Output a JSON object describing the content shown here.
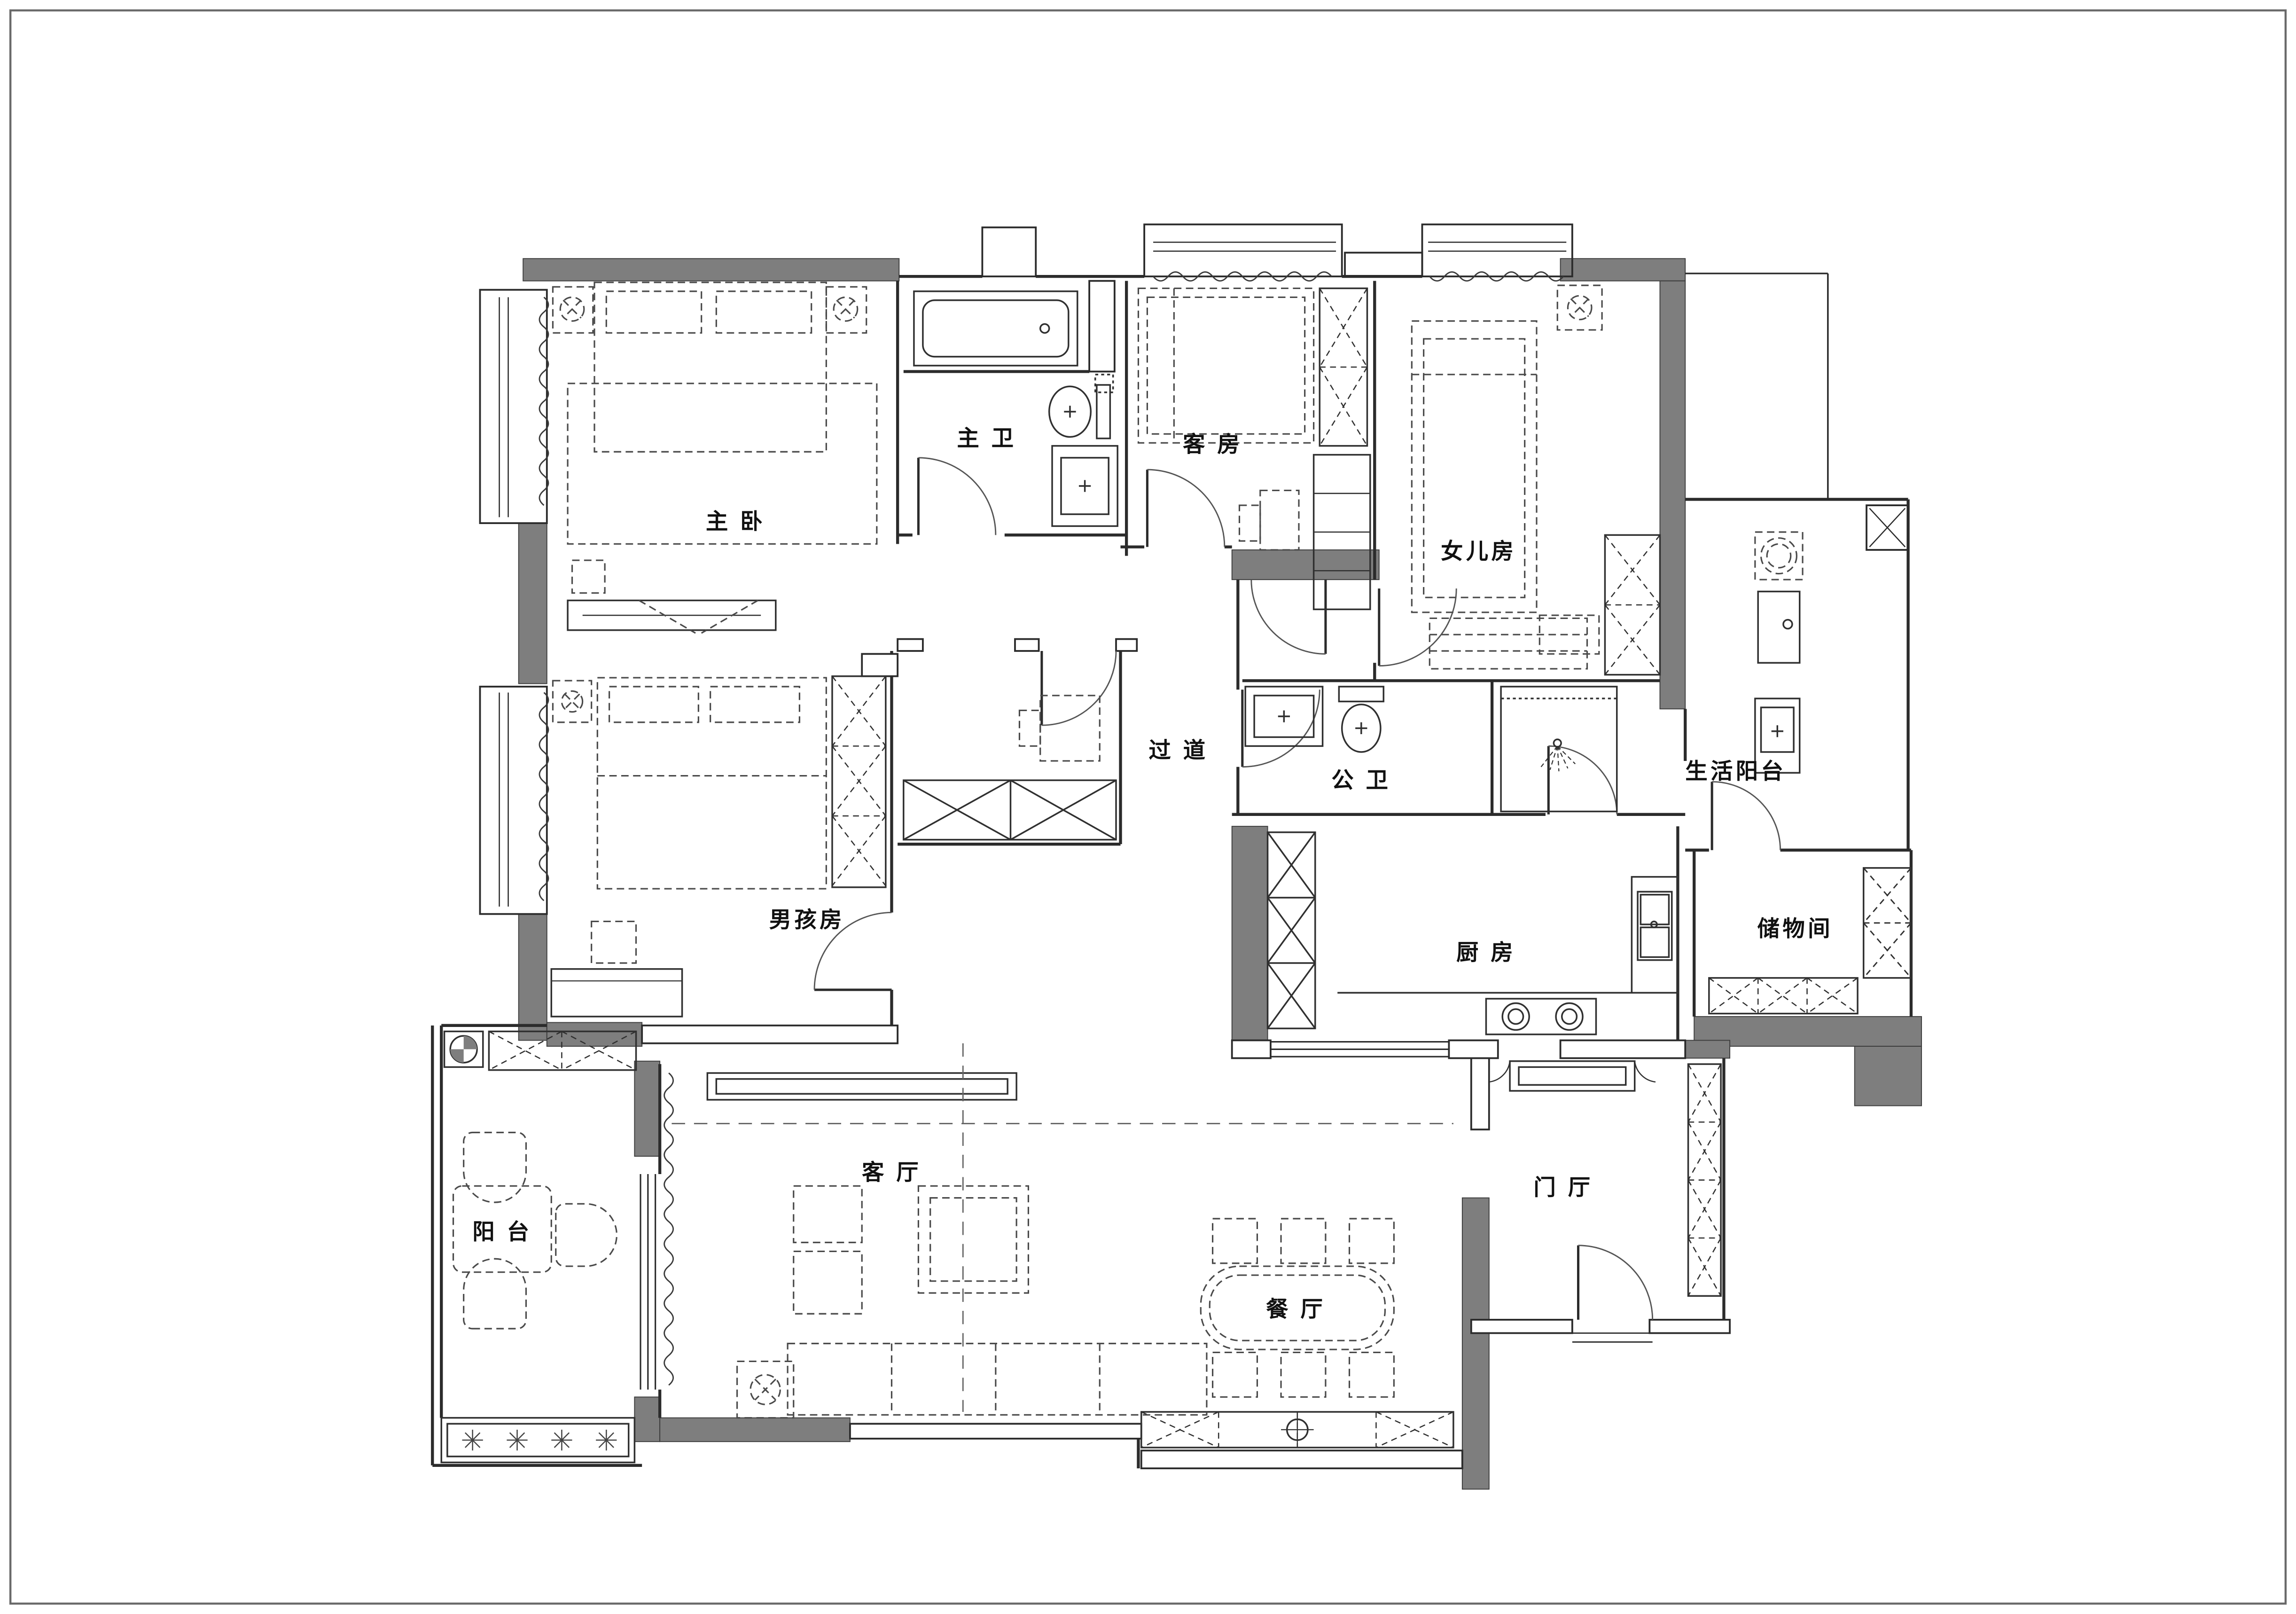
{
  "page": {
    "type": "apartment-floor-plan-drawing",
    "background": "#ffffff",
    "border_color": "#6a6a6a"
  },
  "colors": {
    "structural_wall_fill": "#7e7e7e",
    "wall_line": "#2b2b2b",
    "furniture_line": "#303030",
    "furniture_dashed": "#4a4a4a",
    "label_text": "#111111"
  },
  "floor_plan": {
    "rooms": [
      {
        "id": "master-bedroom",
        "label": "主 卧"
      },
      {
        "id": "master-bath",
        "label": "主 卫"
      },
      {
        "id": "guest-room",
        "label": "客 房"
      },
      {
        "id": "daughter-room",
        "label": "女儿房"
      },
      {
        "id": "hallway",
        "label": "过 道"
      },
      {
        "id": "public-bath",
        "label": "公 卫"
      },
      {
        "id": "service-balcony",
        "label": "生活阳台"
      },
      {
        "id": "boy-room",
        "label": "男孩房"
      },
      {
        "id": "kitchen",
        "label": "厨 房"
      },
      {
        "id": "storage-room",
        "label": "储物间"
      },
      {
        "id": "living-room",
        "label": "客 厅"
      },
      {
        "id": "balcony",
        "label": "阳 台"
      },
      {
        "id": "dining-room",
        "label": "餐 厅"
      },
      {
        "id": "entry-hall",
        "label": "门 厅"
      }
    ]
  }
}
